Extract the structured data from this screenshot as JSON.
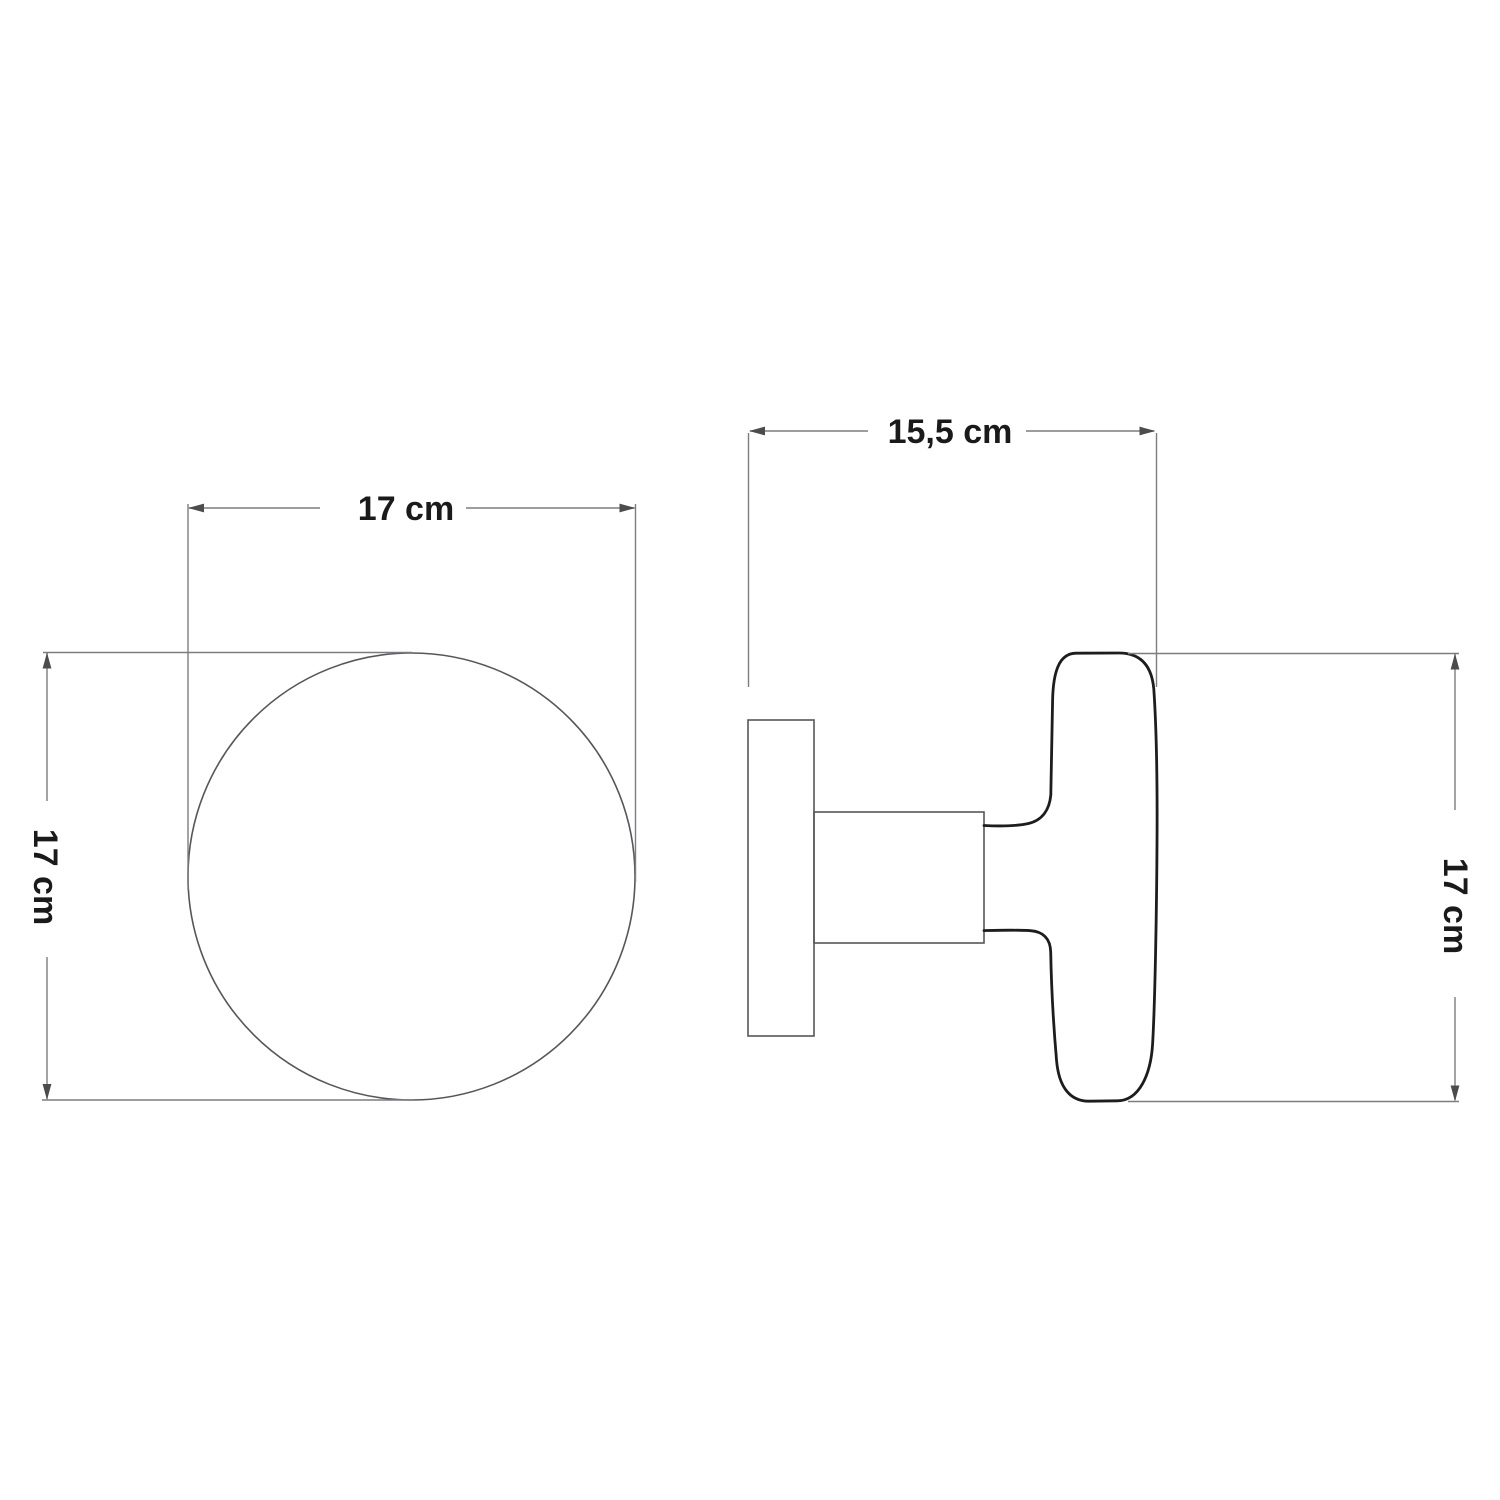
{
  "canvas": {
    "width": 1500,
    "height": 1500,
    "background": "#ffffff"
  },
  "colors": {
    "outline_thick": "#1d1d1d",
    "shape_thin": "#55575a",
    "dimension_line": "#7b7d80",
    "arrow": "#4a4c4e",
    "text": "#1a1a1a"
  },
  "front_view": {
    "name": "knob-front-view",
    "width_dimension": "17 cm",
    "height_dimension": "17 cm"
  },
  "side_view": {
    "name": "knob-side-view",
    "width_dimension": "15,5 cm",
    "height_dimension": "17 cm"
  }
}
